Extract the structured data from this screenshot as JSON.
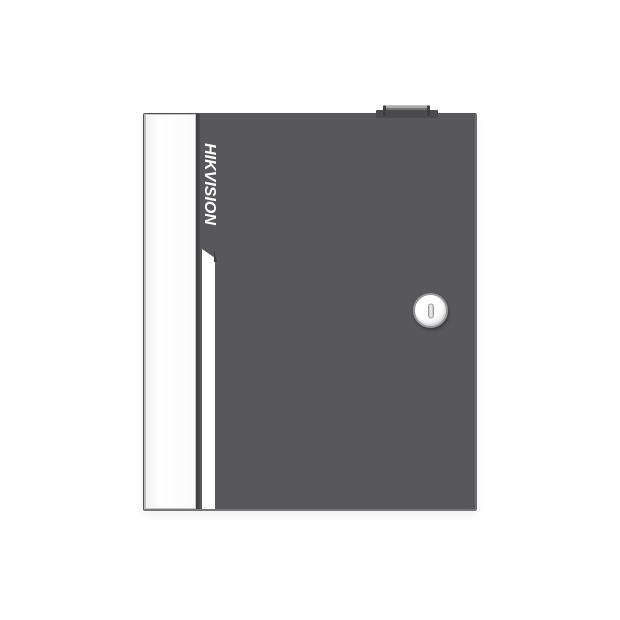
{
  "product": {
    "brand": "HIKVISION"
  },
  "colors": {
    "background": "#FFFFFF",
    "cabinet_gray": "#58585B",
    "side_panel_white": "#FCFCFC",
    "accent_stripe_white": "#FEFEFE",
    "logo_text_white": "#FFFFFF",
    "tamper_bump_dark": "#4A4A4C",
    "lock_ring_gray": "#97979A"
  },
  "icons": {
    "lock": "keyhole-lock-icon",
    "bump": "tamper-switch-bump"
  }
}
